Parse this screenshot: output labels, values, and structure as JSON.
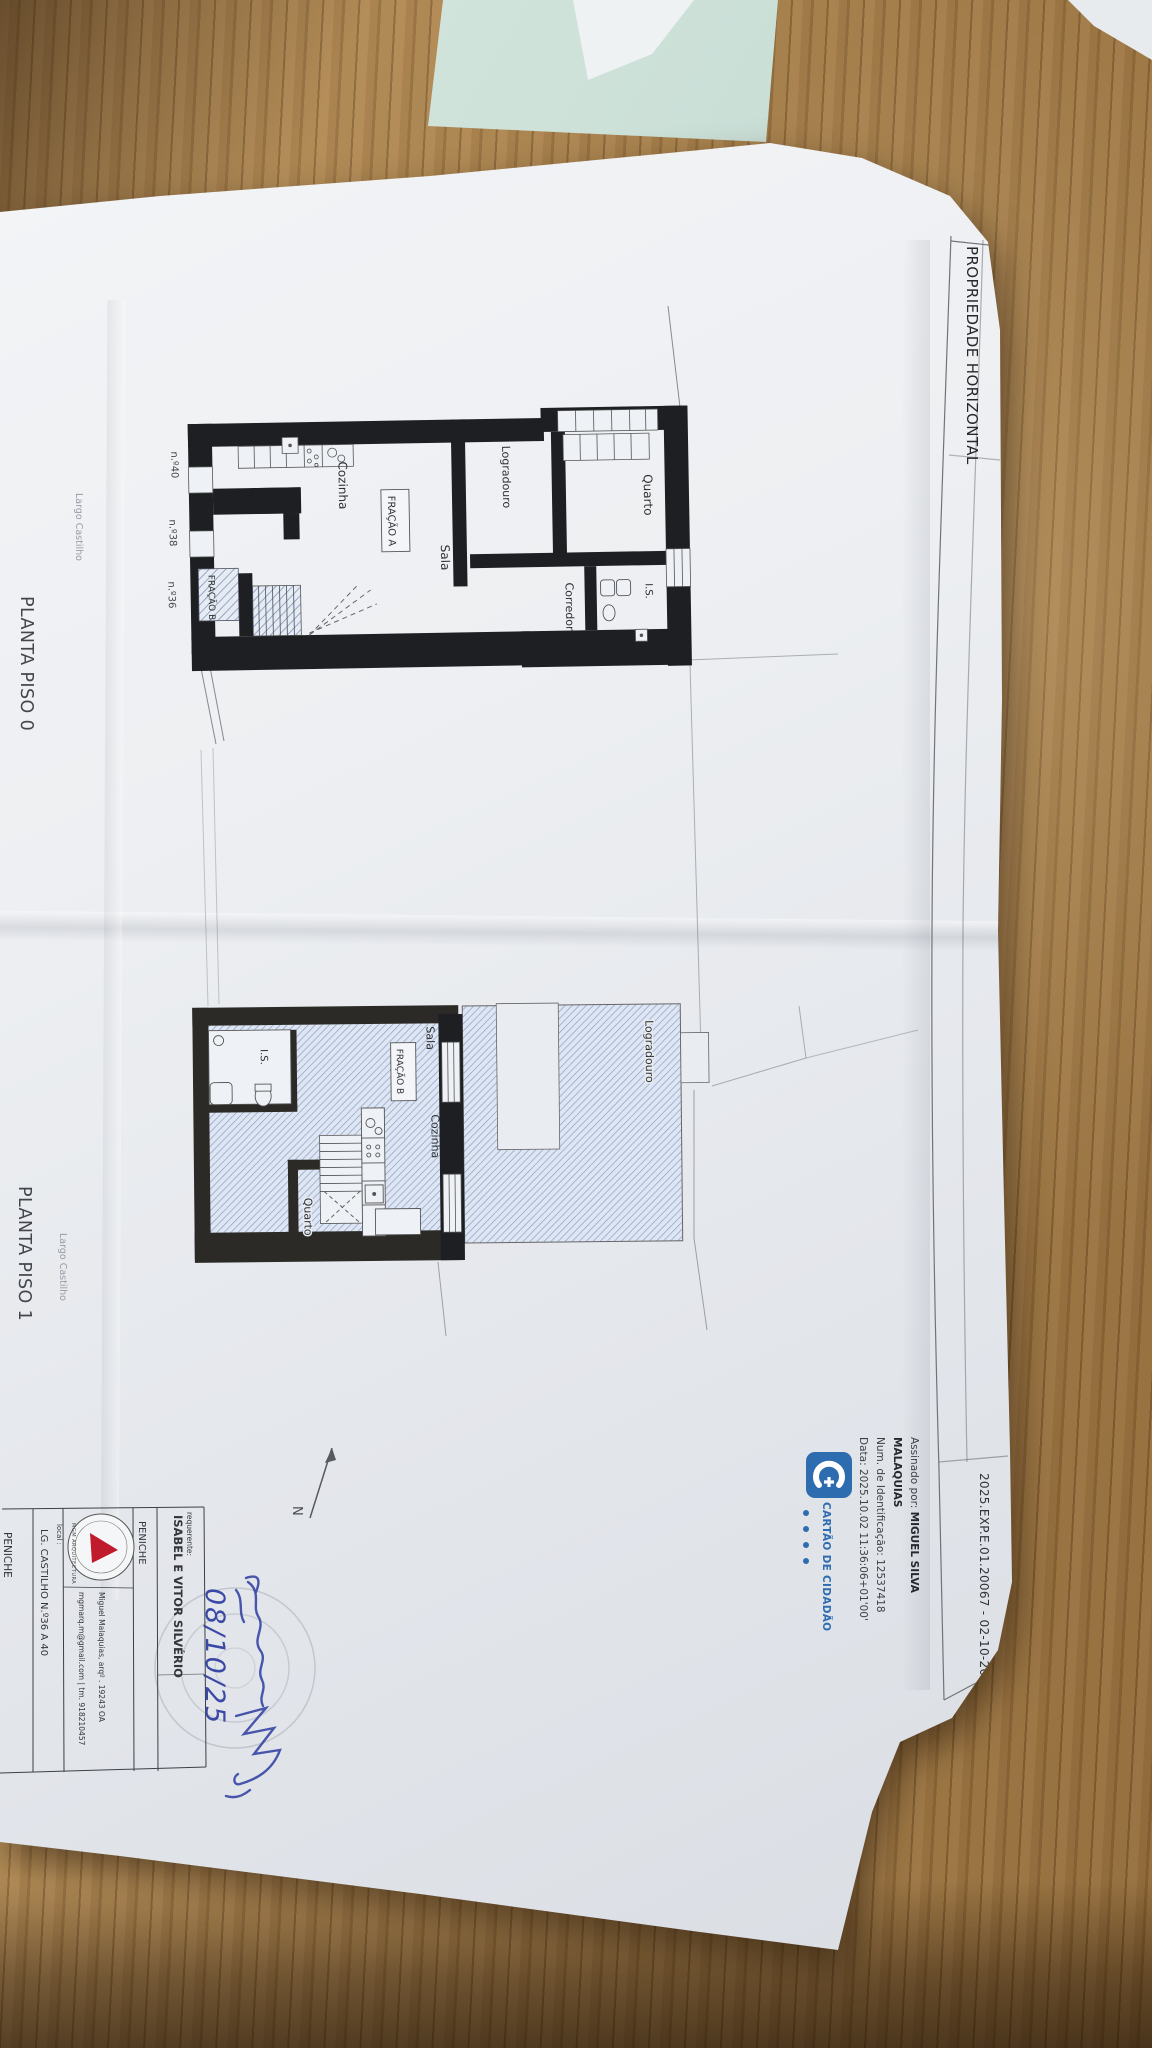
{
  "colors": {
    "wood": "#a87f4c",
    "paper": "#eef0f3",
    "teal_paper": "#cfe2da",
    "plan_hatch_blue": "#8ca6cc",
    "wall_black": "#1d1f22",
    "existing_wall": "#2b2a26",
    "ink_blue": "#3a49a6",
    "card_blue": "#2e6cb0",
    "logo_red": "#c01b2d"
  },
  "document": {
    "frame_title": "PROPRIEDADE HORIZONTAL",
    "reference": "2025.EXP.E.01.20067 - 02-10-2025",
    "north_label": "N",
    "digital_signature": {
      "prefix": "Assinado por: ",
      "name_line1": "MIGUEL SILVA",
      "name_line2": "MALAQUIAS",
      "id_line": "Num. de Identificação: 12537418",
      "date_line": "Data: 2025.10.02 11:36:06+01'00'",
      "card_label": "CARTÃO DE CIDADÃO"
    },
    "plans": {
      "piso0": {
        "label": "PLANTA PISO 0",
        "street": "Largo Castilho",
        "door_numbers": [
          "n.º40",
          "n.º38",
          "n.º36"
        ],
        "rooms": {
          "cozinha": "Cozinha",
          "fracao_a": "FRAÇÃO A",
          "sala": "Sala",
          "fracao_b": "FRAÇÃO B",
          "logradouro": "Logradouro",
          "quarto": "Quarto",
          "corredor": "Corredor",
          "is": "I.S."
        }
      },
      "piso1": {
        "label": "PLANTA PISO 1",
        "street": "Largo Castilho",
        "rooms": {
          "sala": "Sala",
          "fracao_b": "FRAÇÃO B",
          "cozinha": "Cozinha",
          "is": "I.S.",
          "quarto": "Quarto",
          "logradouro": "Logradouro"
        }
      }
    },
    "title_block": {
      "requerente_label": "requerente:",
      "requerente_name": "ISABEL E VITOR SILVÉRIO",
      "requerente_city": "PENICHE",
      "architect_logo": "MGM ARQUITECTURA",
      "architect_line1": "Miguel Malaquias, arqº  .  19243 OA",
      "architect_line2": "mgmarq.m@gmail.com  |  tm. 918210457",
      "local_label": "local :",
      "local_address": "LG. CASTILHO N.º36 A 40",
      "local_city": "PENICHE"
    },
    "handwriting": {
      "date": "08/10/25"
    }
  }
}
